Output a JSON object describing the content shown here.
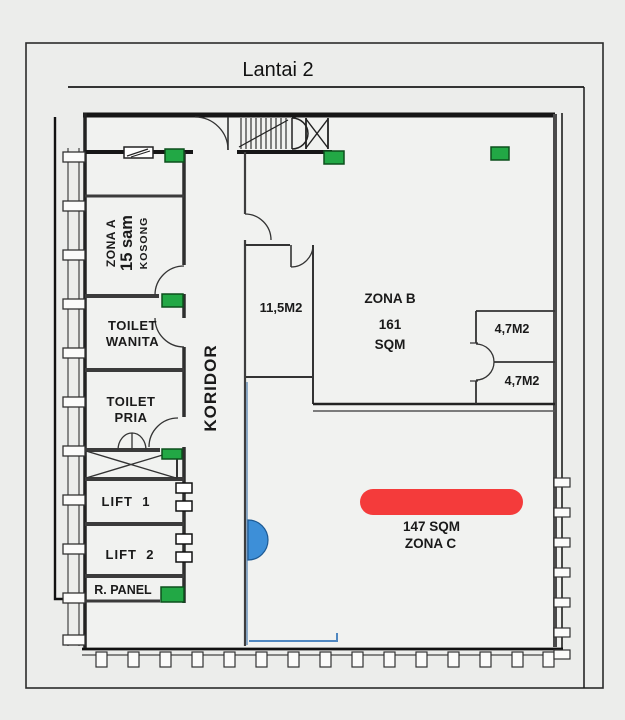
{
  "title": "Lantai 2",
  "colors": {
    "marker_green": "#22a845",
    "highlight_red": "#f43b3b",
    "door_blue": "#3d8fd8",
    "wall_dark": "#1c1c1c"
  },
  "icons": {
    "exit_marker": "green-rectangle-marker",
    "vent": "louver-vent-symbol",
    "stairs": "staircase-symbol",
    "shaft": "x-crossed-shaft",
    "door_highlight": "blue-half-circle-door",
    "zona_c_highlight": "red-pill-highlight"
  },
  "labels": {
    "zona_a": {
      "name": "ZONA A",
      "area": "15 sam",
      "status": "KOSONG"
    },
    "toilet_wanita": {
      "line1": "TOILET",
      "line2": "WANITA"
    },
    "toilet_pria": {
      "line1": "TOILET",
      "line2": "PRIA"
    },
    "lift_1": "LIFT  1",
    "lift_2": "LIFT  2",
    "r_panel": "R. PANEL",
    "koridor": "KORIDOR",
    "room_11_5m2": "11,5M2",
    "zona_b": {
      "name": "ZONA B",
      "area_value": "161",
      "area_unit": "SQM"
    },
    "room_4_7m2_upper": "4,7M2",
    "room_4_7m2_lower": "4,7M2",
    "zona_c": {
      "area": "147 SQM",
      "name": "ZONA C"
    }
  }
}
